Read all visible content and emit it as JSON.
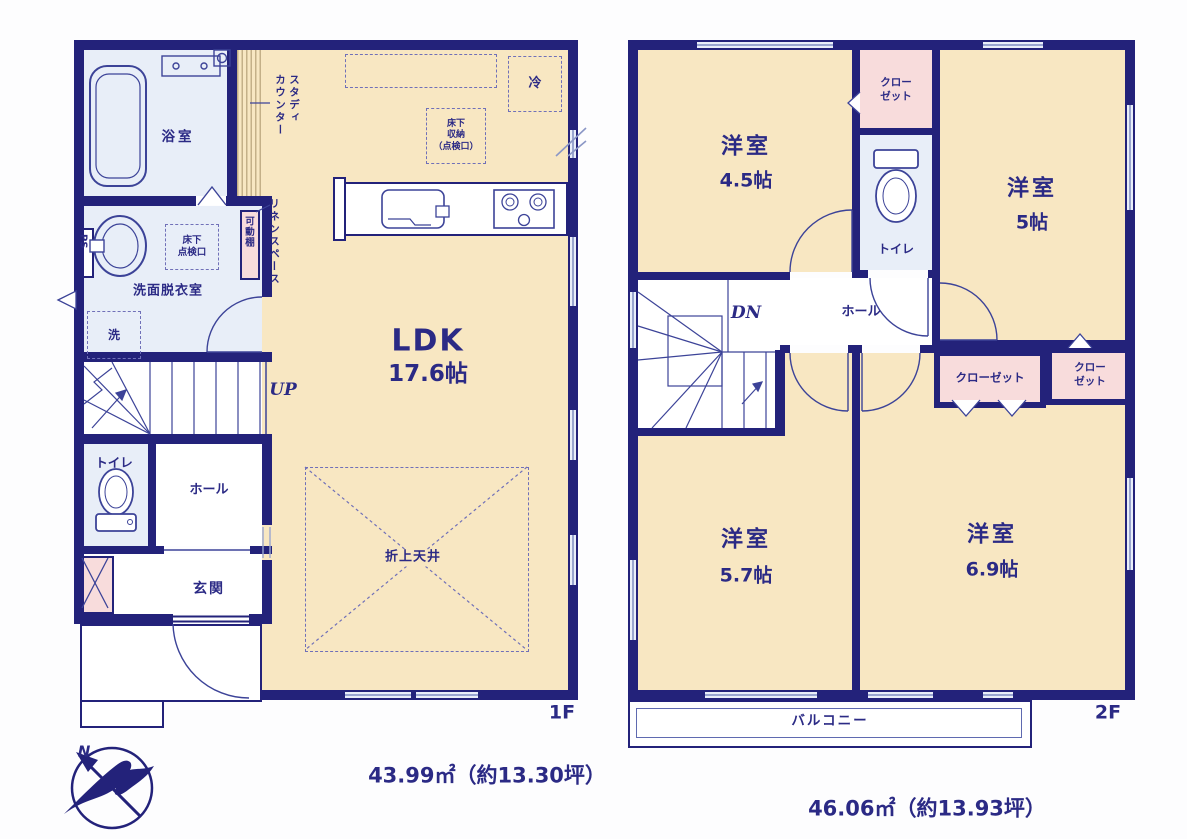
{
  "title": "間取り図",
  "colors": {
    "wall": "#23227a",
    "ink": "#2b2a85",
    "room_cream": "#f8e7c2",
    "wet_blue": "#e8eef8",
    "closet_pink": "#f8dcdc",
    "window_fill": "#e9eef9"
  },
  "floor1": {
    "floor_tag": "1F",
    "area_text": "43.99㎡（約13.30坪）",
    "rooms": {
      "ldk": {
        "name": "LDK",
        "size": "17.6帖"
      },
      "bath": {
        "label": "浴室"
      },
      "washroom": {
        "label": "洗面脱衣室"
      },
      "toilet": {
        "label": "トイレ"
      },
      "hall": {
        "label": "ホール"
      },
      "entrance": {
        "label": "玄関"
      },
      "stairs_up": {
        "label": "UP"
      },
      "study_counter": {
        "lines": [
          "スタディ",
          "カウンター"
        ]
      },
      "linen_space": {
        "label": "リネンスペース"
      },
      "movable_shelf": {
        "label": "可動棚"
      },
      "pipe_space": {
        "label": "PS"
      },
      "underfloor_hatch": {
        "lines": [
          "床下",
          "点検口"
        ]
      },
      "washer": {
        "label": "洗"
      },
      "fridge": {
        "label": "冷"
      },
      "underfloor_storage": {
        "lines": [
          "床下",
          "収納",
          "（点検口）"
        ]
      },
      "coffered_ceiling": {
        "label": "折上天井"
      }
    }
  },
  "floor2": {
    "floor_tag": "2F",
    "area_text": "46.06㎡（約13.93坪）",
    "rooms": {
      "room_45": {
        "name": "洋室",
        "size": "4.5帖"
      },
      "room_5": {
        "name": "洋室",
        "size": "5帖"
      },
      "room_57": {
        "name": "洋室",
        "size": "5.7帖"
      },
      "room_69": {
        "name": "洋室",
        "size": "6.9帖"
      },
      "toilet": {
        "label": "トイレ"
      },
      "hall": {
        "label": "ホール"
      },
      "stairs_down": {
        "label": "DN"
      },
      "closet_top": {
        "lines": [
          "クロー",
          "ゼット"
        ]
      },
      "closet_wide": {
        "label": "クローゼット"
      },
      "closet_narrow": {
        "lines": [
          "クロー",
          "ゼット"
        ]
      },
      "balcony": {
        "label": "バルコニー"
      }
    }
  },
  "compass": {
    "north_label": "N"
  }
}
